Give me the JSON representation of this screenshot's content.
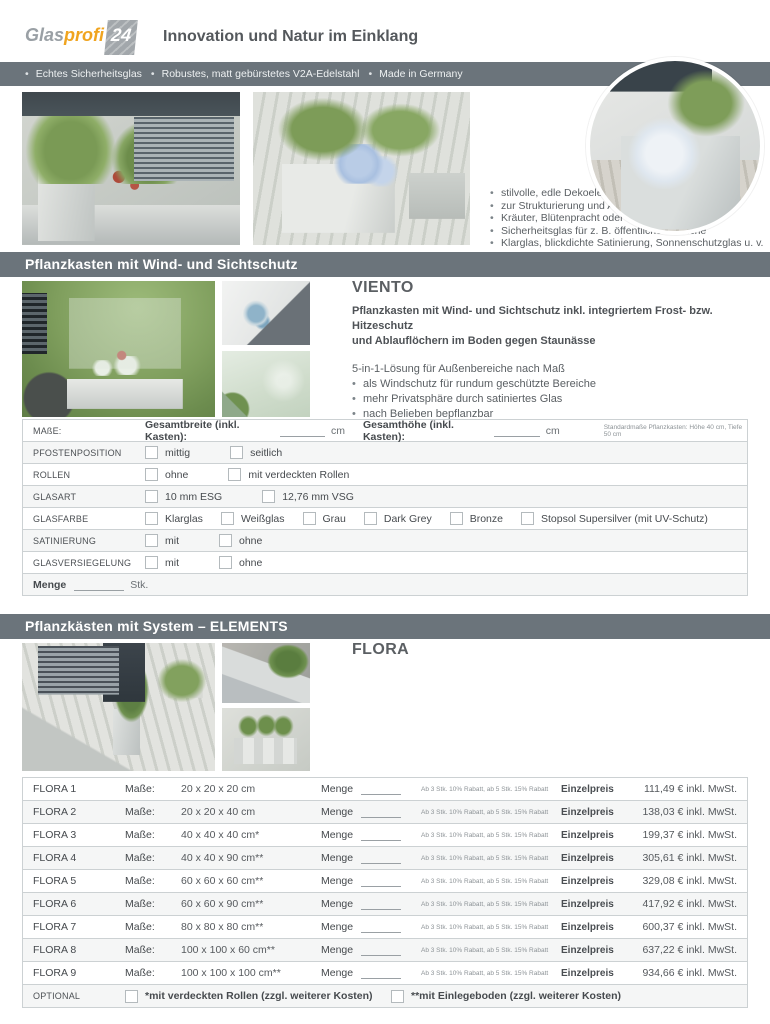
{
  "colors": {
    "bar": "#6b747b",
    "accent_orange": "#f0a41f",
    "border": "#ccd1d3",
    "row_alt": "#f5f6f6"
  },
  "header": {
    "logo_glas": "Glas",
    "logo_profi": "profi",
    "logo_24": "24",
    "tagline": "Innovation und Natur im Einklang"
  },
  "topbar": {
    "items": [
      "Echtes Sicherheitsglas",
      "Robustes, matt gebürstetes V2A-Edelstahl",
      "Made in Germany"
    ]
  },
  "intro": {
    "bullets": [
      "stilvolle, edle Dekoelemente",
      "zur Strukturierung und Abtrennung von Bereichen",
      "Kräuter, Blütenpracht oder urbaner Dschungel",
      "Sicherheitsglas für z. B. öffentliche Bereiche",
      "Klarglas, blickdichte Satinierung, Sonnenschutzglas u. v. m."
    ]
  },
  "viento": {
    "section_title": "Pflanzkasten mit Wind- und Sichtschutz",
    "title": "VIENTO",
    "bold_lines": [
      "Pflanzkasten mit Wind- und Sichtschutz inkl. integriertem Frost- bzw. Hitzeschutz",
      "und Ablauflöchern im Boden gegen Staunässe"
    ],
    "lead": "5-in-1-Lösung für Außenbereiche nach Maß",
    "bullets": [
      "als Windschutz für rundum geschützte Bereiche",
      "mehr Privatsphäre durch satiniertes Glas",
      "nach Belieben bepflanzbar",
      "lebendige Strukturierung von Aufenthaltsbereichen und Sitzecken",
      "Umgebungsaufwertung durch dekorative Elemente"
    ]
  },
  "order_form": {
    "masse_label": "MAßE:",
    "breite_label": "Gesamtbreite (inkl. Kasten):",
    "hoehe_label": "Gesamthöhe (inkl. Kasten):",
    "unit": "cm",
    "note": "Standardmaße Pflanzkasten: Höhe 40 cm, Tiefe 50 cm",
    "rows": [
      {
        "label": "PFOSTENPOSITION",
        "options": [
          "mittig",
          "seitlich"
        ]
      },
      {
        "label": "ROLLEN",
        "options": [
          "ohne",
          "mit verdeckten Rollen"
        ]
      },
      {
        "label": "GLASART",
        "options": [
          "10 mm ESG",
          "12,76 mm VSG"
        ]
      },
      {
        "label": "GLASFARBE",
        "options": [
          "Klarglas",
          "Weißglas",
          "Grau",
          "Dark Grey",
          "Bronze",
          "Stopsol Supersilver (mit UV-Schutz)"
        ]
      },
      {
        "label": "SATINIERUNG",
        "options": [
          "mit",
          "ohne"
        ]
      },
      {
        "label": "GLASVERSIEGELUNG",
        "options": [
          "mit",
          "ohne"
        ]
      }
    ],
    "menge_label": "Menge",
    "menge_unit": "Stk."
  },
  "flora": {
    "section_title": "Pflanzkästen mit System – ELEMENTS",
    "title": "FLORA",
    "bold_lines": [
      "Quadratische Pflanzsäule mit integriertem Frost- bzw. Hitzeschutz",
      "und Ablauflöchern im Boden gegen Staunässe",
      "Zulassung als Brüstung möglich"
    ],
    "lines": [
      "Jetzt einzeln bestellen",
      "oder individuell mit PRADO und/ oder LAGO kombinieren und sparen",
      "Wunschgröße nicht dabei? Fragen Sie Ihre individuellen Maße bei uns an!"
    ],
    "table": {
      "masse_label": "Maße:",
      "menge_label": "Menge",
      "rabatt_note": "Ab 3 Stk. 10% Rabatt, ab 5 Stk. 15% Rabatt",
      "einzelpreis_label": "Einzelpreis",
      "rows": [
        {
          "name": "FLORA 1",
          "size": "20 x 20 x 20 cm",
          "price": "111,49 € inkl. MwSt."
        },
        {
          "name": "FLORA 2",
          "size": "20 x 20 x 40 cm",
          "price": "138,03 € inkl. MwSt."
        },
        {
          "name": "FLORA 3",
          "size": "40 x 40 x 40 cm*",
          "price": "199,37 € inkl. MwSt."
        },
        {
          "name": "FLORA 4",
          "size": "40 x 40 x 90 cm**",
          "price": "305,61 € inkl. MwSt."
        },
        {
          "name": "FLORA 5",
          "size": "60 x 60 x 60 cm**",
          "price": "329,08 € inkl. MwSt."
        },
        {
          "name": "FLORA 6",
          "size": "60 x 60 x 90 cm**",
          "price": "417,92 € inkl. MwSt."
        },
        {
          "name": "FLORA 7",
          "size": "80 x 80 x 80 cm**",
          "price": "600,37 € inkl. MwSt."
        },
        {
          "name": "FLORA 8",
          "size": "100 x 100 x 60 cm**",
          "price": "637,22 € inkl. MwSt."
        },
        {
          "name": "FLORA 9",
          "size": "100 x 100 x 100 cm**",
          "price": "934,66 € inkl. MwSt."
        }
      ]
    },
    "optional": {
      "label": "OPTIONAL",
      "options": [
        "*mit verdeckten Rollen (zzgl. weiterer Kosten)",
        "**mit Einlegeboden (zzgl. weiterer Kosten)"
      ]
    }
  }
}
